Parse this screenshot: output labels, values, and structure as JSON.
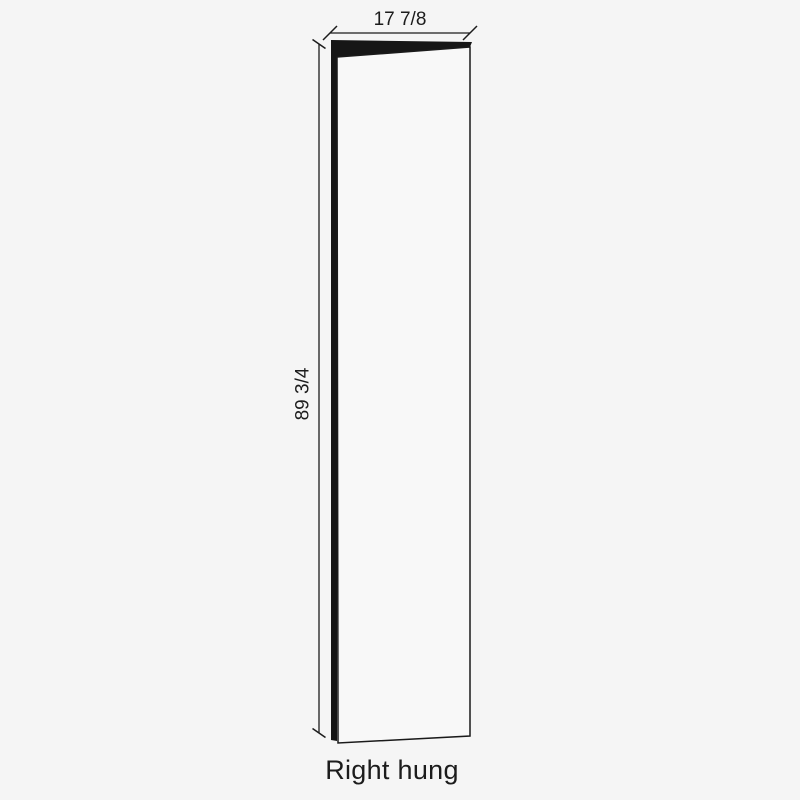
{
  "diagram": {
    "caption": "Right hung",
    "width_dimension": {
      "label": "17 7/8"
    },
    "height_dimension": {
      "label": "89 3/4"
    }
  },
  "colors": {
    "background": "#f5f5f5",
    "line": "#1c1c1c",
    "edge_fill": "#161616",
    "door_face": "#f8f8f8",
    "text": "#1c1c1c"
  }
}
